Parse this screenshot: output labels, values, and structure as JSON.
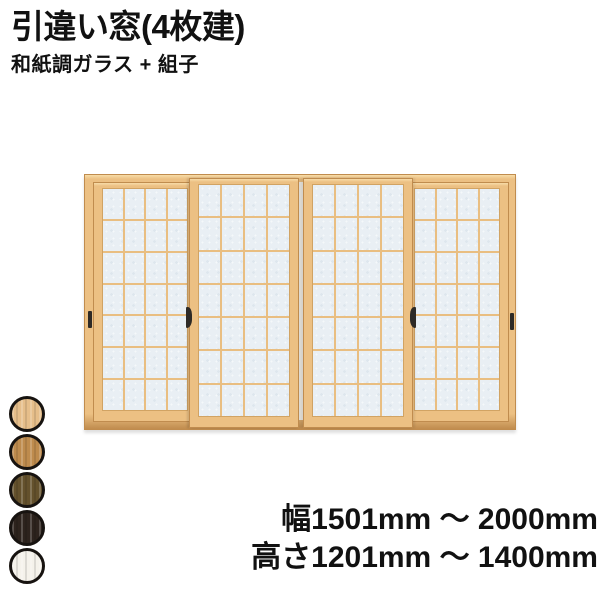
{
  "header": {
    "title": "引違い窓(4枚建)",
    "subtitle": "和紙調ガラス + 組子"
  },
  "window": {
    "panel_count": 4,
    "kumiko_grid": {
      "cols": 4,
      "rows": 7
    },
    "colors": {
      "wood": "#ECC083",
      "wood_highlight": "#F7DCA8",
      "wood_border": "#C08C4E",
      "glass": "#E9EFF4",
      "kumiko": "#E9BE81",
      "track": "#F1EDE5",
      "handle": "#2E2A26"
    }
  },
  "color_swatches": {
    "options": [
      {
        "name": "light-wood",
        "hex": "#E6BE8A"
      },
      {
        "name": "golden-oak",
        "hex": "#BE8B4D"
      },
      {
        "name": "dark-walnut",
        "hex": "#64512C"
      },
      {
        "name": "dark-brown",
        "hex": "#2D231D"
      },
      {
        "name": "white",
        "hex": "#F5F2EB"
      }
    ]
  },
  "specs": {
    "width_range": "幅1501mm ～ 2000mm",
    "height_range": "高さ1201mm ～ 1400mm"
  }
}
